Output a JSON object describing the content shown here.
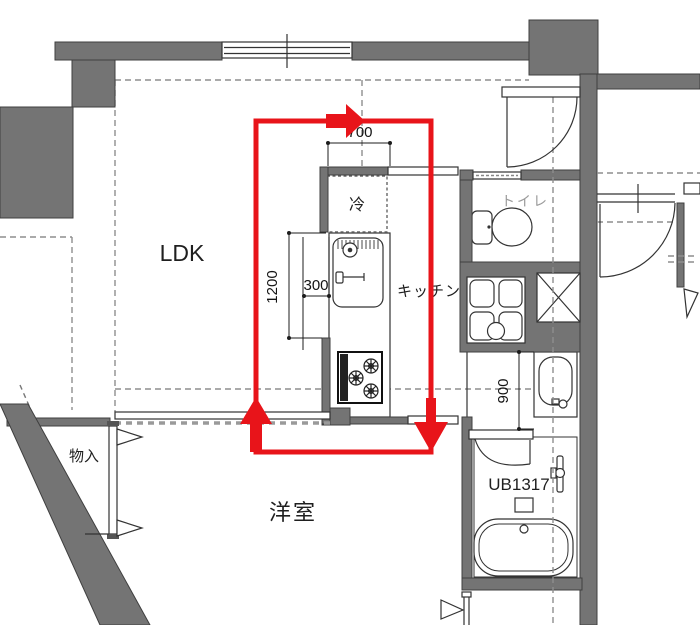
{
  "floor_plan": {
    "rooms": {
      "ldk": {
        "label": "LDK"
      },
      "kitchen": {
        "label": "キッチン"
      },
      "western_room": {
        "label": "洋室"
      },
      "toilet": {
        "label": "トイレ"
      },
      "storage": {
        "label": "物入"
      },
      "unit_bath": {
        "label": "UB1317"
      },
      "refrigerator": {
        "label": "冷"
      }
    },
    "dimensions_mm": {
      "fridge_space_width": "700",
      "counter_length": "1200",
      "counter_offset": "300",
      "washroom_depth": "900"
    },
    "colors": {
      "wall_gray": "#747474",
      "wall_outline": "#3f3f3f",
      "dashed_boundary": "#8e8e8e",
      "highlight_red": "#e8141a",
      "label_text": "#1f1f1f",
      "muted_label": "#9b9b9b"
    }
  }
}
